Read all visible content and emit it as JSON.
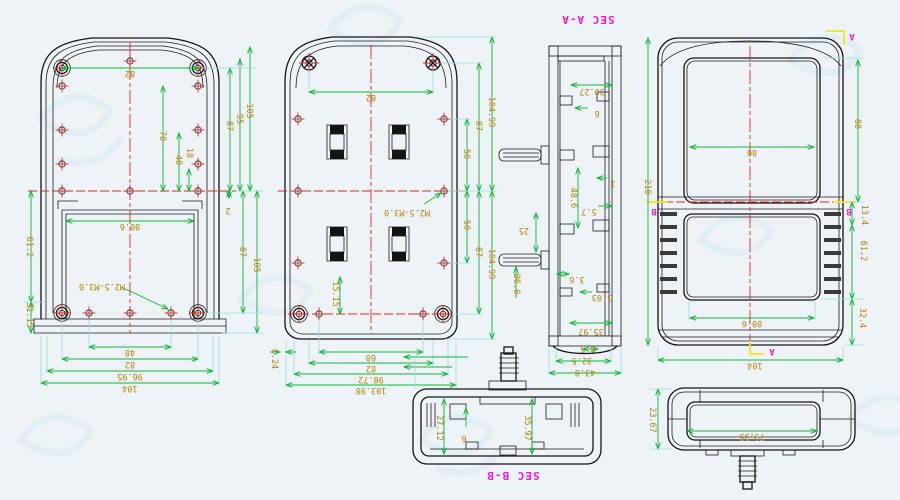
{
  "sheet": {
    "type": "enclosure-engineering-drawing"
  },
  "colors": {
    "background": "#eef3f8",
    "outline": "#141414",
    "dimension_line": "#0cb832",
    "dimension_text": "#b8860b",
    "centerline": "#e8261c",
    "extension_line": "#9adfe0",
    "section_label": "#ee1cd2",
    "section_cut": "#f2e70c",
    "hatch": "#f8f340"
  },
  "v1": {
    "name": "base-interior-view",
    "d82": "82",
    "d78": "78",
    "d48": "48",
    "d18": "18",
    "d87u": "87",
    "d95": "95",
    "d105u": "105",
    "d2": "2",
    "d87l": "87",
    "d105l": "105",
    "db48": "48",
    "db82": "82",
    "db9695": "96.95",
    "db104": "104",
    "dl612": "61.2",
    "dl3115": "31.15",
    "dwin": "80.6",
    "note": "M2.5-M3.0"
  },
  "v2": {
    "name": "base-exterior-view",
    "d82": "82",
    "d50u": "50",
    "d87u": "87",
    "d104u": "104.99",
    "d50l": "50",
    "d87l": "87",
    "d104l": "104.99",
    "db60": "60",
    "db82": "82",
    "db9872": "98.72",
    "db10398": "103.98",
    "dl124": "1.24",
    "d1515": "15.15",
    "note": "M2.5-M3.0"
  },
  "saa": {
    "title": "SEC A-A",
    "d3027": "30.27",
    "d6": "6",
    "d1": "1",
    "d486": "48.6",
    "d57": "5.7",
    "d25": "25",
    "dia": "Ø6.0",
    "d36": "3.6",
    "d303": "3.03",
    "d3597": "35.97",
    "d85": "8.5",
    "d325": "32.5",
    "d438": "43.8"
  },
  "vf": {
    "name": "front-view",
    "d210": "210",
    "d88": "88",
    "d134": "13.4",
    "d612": "61.2",
    "d324": "32.4",
    "d80": "80",
    "d806": "80.6",
    "d104": "104",
    "ma": "A",
    "mb": "B"
  },
  "sbb": {
    "title": "SEC B-B",
    "d2712": "27.12",
    "d6": "6",
    "d3597": "35.97"
  },
  "vt": {
    "name": "top-view",
    "d7935": "79.35",
    "d2367": "23.67"
  }
}
